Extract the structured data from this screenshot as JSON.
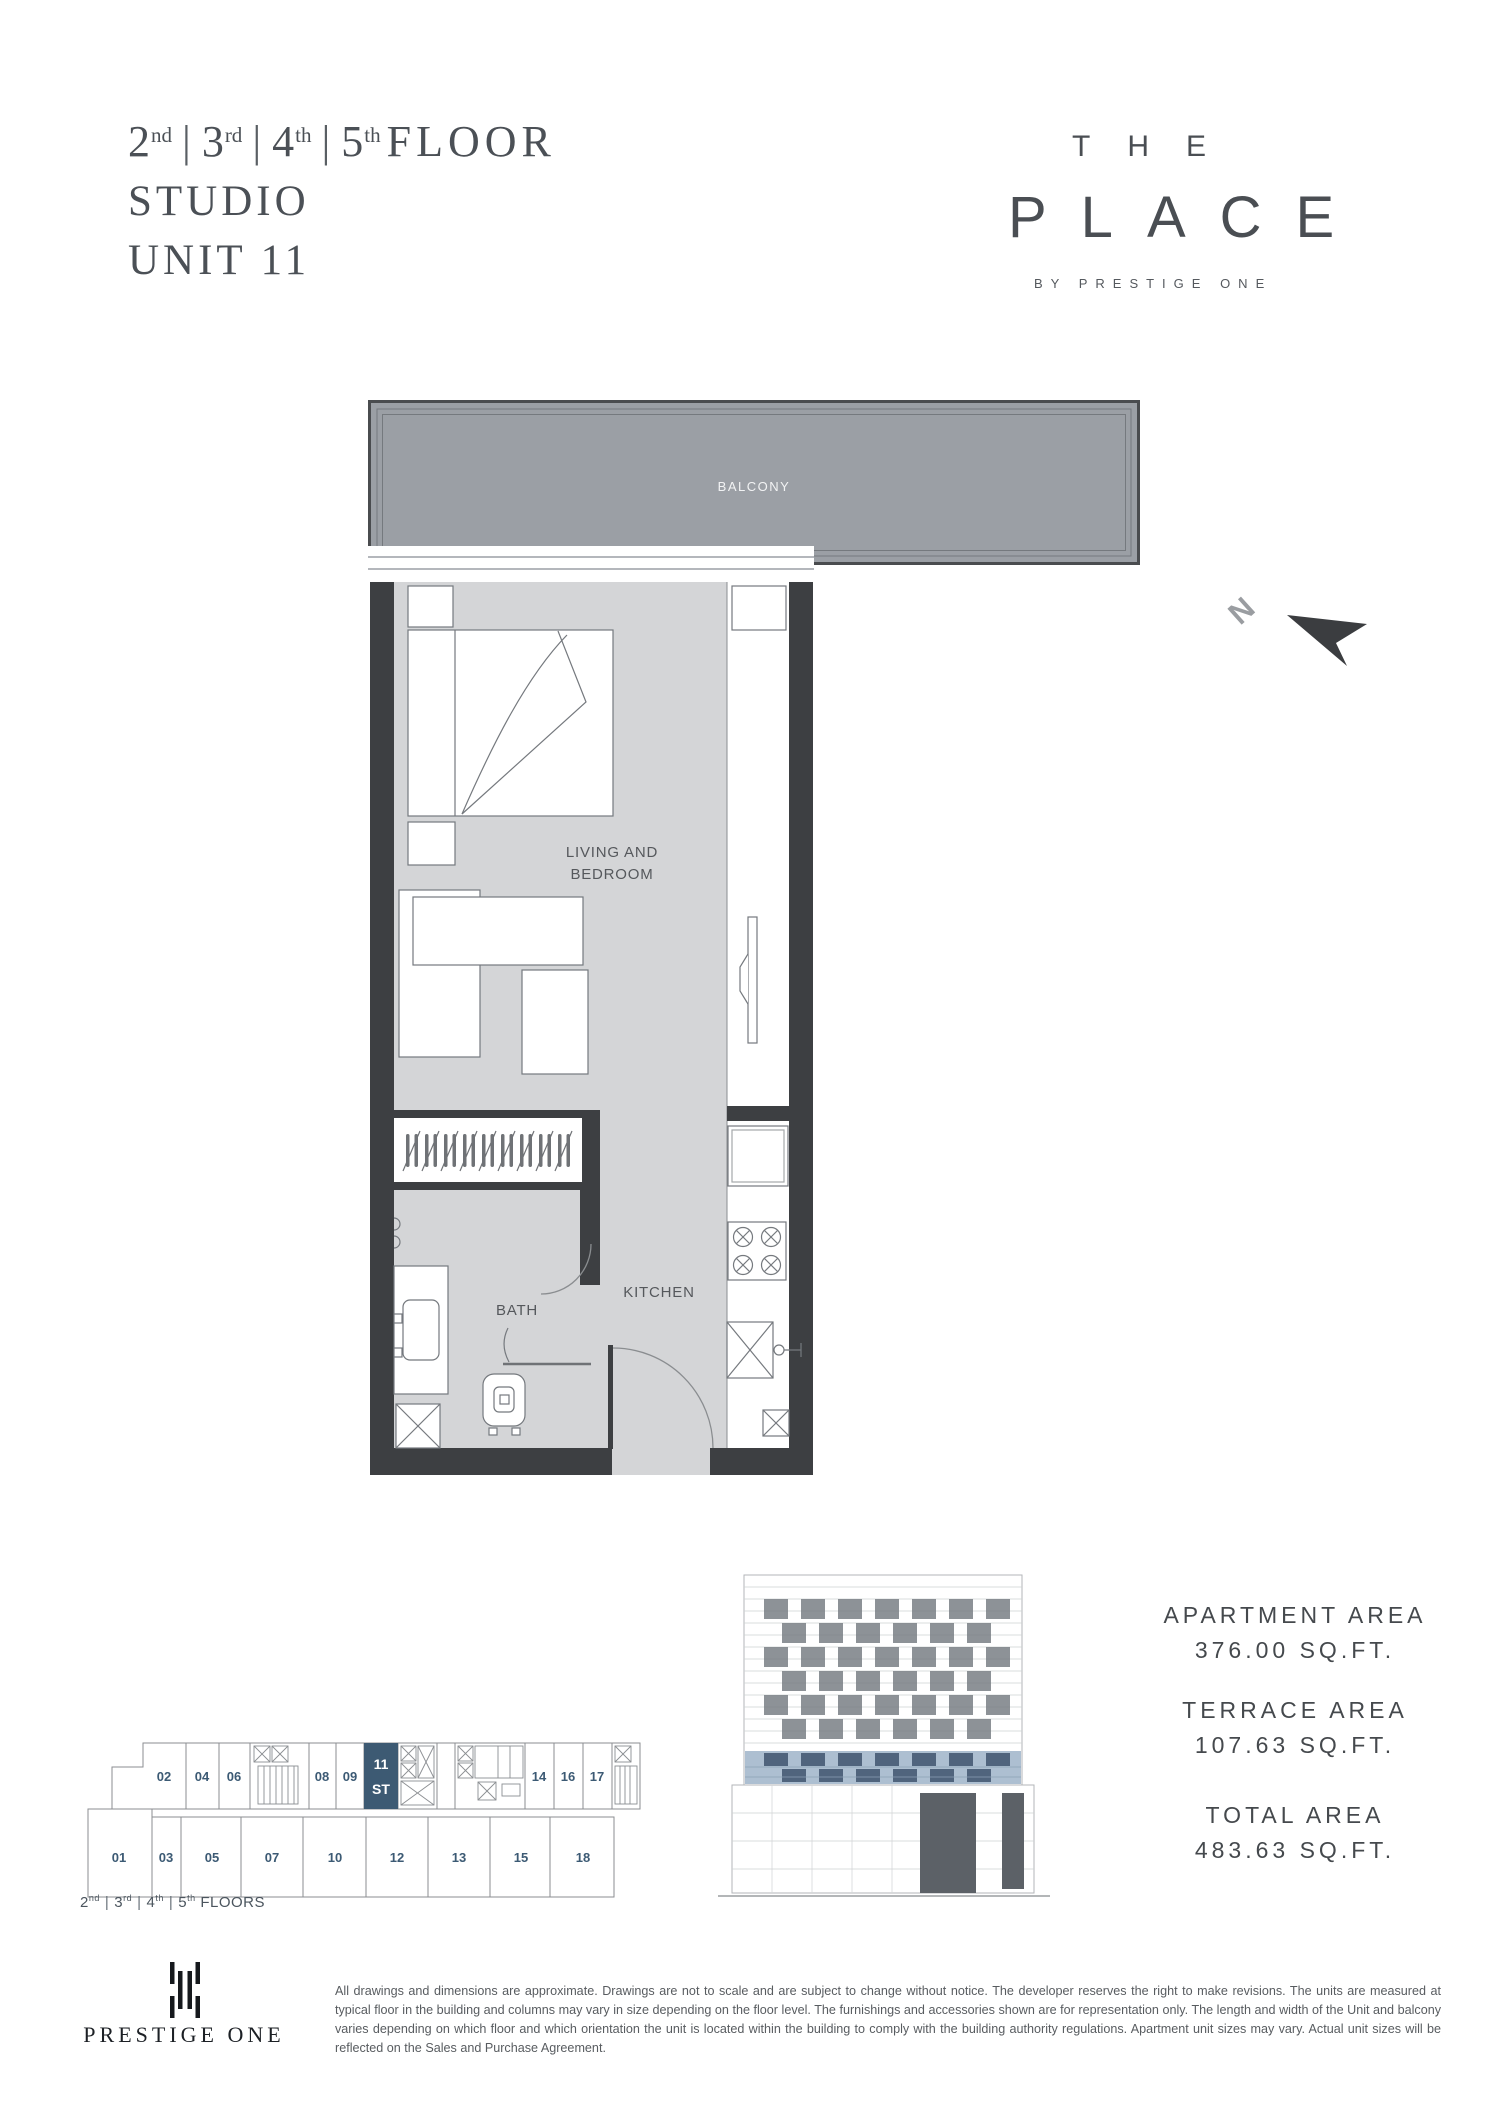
{
  "title": {
    "floors": [
      {
        "n": "2",
        "s": "nd"
      },
      {
        "n": "3",
        "s": "rd"
      },
      {
        "n": "4",
        "s": "th"
      },
      {
        "n": "5",
        "s": "th"
      }
    ],
    "sep": "|",
    "suffix": "FLOOR",
    "line2": "STUDIO",
    "line3": "UNIT 11"
  },
  "brand": {
    "line1": "THE",
    "line2": "PLACE",
    "line3": "BY PRESTIGE ONE"
  },
  "plan": {
    "balcony_label": "BALCONY",
    "living_label_1": "LIVING AND",
    "living_label_2": "BEDROOM",
    "bath_label": "BATH",
    "kitchen_label": "KITCHEN",
    "north_label": "N"
  },
  "keyplan": {
    "top_units_left": [
      "02",
      "04",
      "06"
    ],
    "top_units_mid": [
      "08",
      "09"
    ],
    "highlight_unit": {
      "num": "11",
      "type": "ST"
    },
    "top_units_right": [
      "14",
      "16",
      "17"
    ],
    "bottom_units": [
      "01",
      "03",
      "05",
      "07",
      "10",
      "12",
      "13",
      "15",
      "18"
    ],
    "caption": [
      {
        "n": "2",
        "s": "nd"
      },
      {
        "n": "3",
        "s": "rd"
      },
      {
        "n": "4",
        "s": "th"
      },
      {
        "n": "5",
        "s": "th"
      }
    ],
    "caption_suffix": "FLOORS"
  },
  "areas": {
    "items": [
      {
        "label": "APARTMENT AREA",
        "value": "376.00 SQ.FT."
      },
      {
        "label": "TERRACE AREA",
        "value": "107.63 SQ.FT."
      },
      {
        "label": "TOTAL  AREA",
        "value": "483.63 SQ.FT."
      }
    ]
  },
  "footer": {
    "brand": "PRESTIGE ONE",
    "disclaimer": "All drawings and dimensions are approximate. Drawings are not to scale and are subject to change without notice. The developer reserves the right to make revisions. The units are measured at typical floor in the building and columns may vary in size depending on the floor level. The furnishings and accessories shown are for representation only. The length and width of the Unit and balcony varies depending on which floor and which orientation the unit is located within the building to comply with the building authority regulations. Apartment unit sizes may vary. Actual unit sizes will be reflected on the Sales and Purchase Agreement."
  },
  "colors": {
    "accent_blue": "#3d5a73",
    "unit_number_blue": "#3c5a74",
    "wall": "#3d3f42",
    "balcony_fill": "#9b9fa5",
    "floor_fill": "#d4d5d7"
  }
}
